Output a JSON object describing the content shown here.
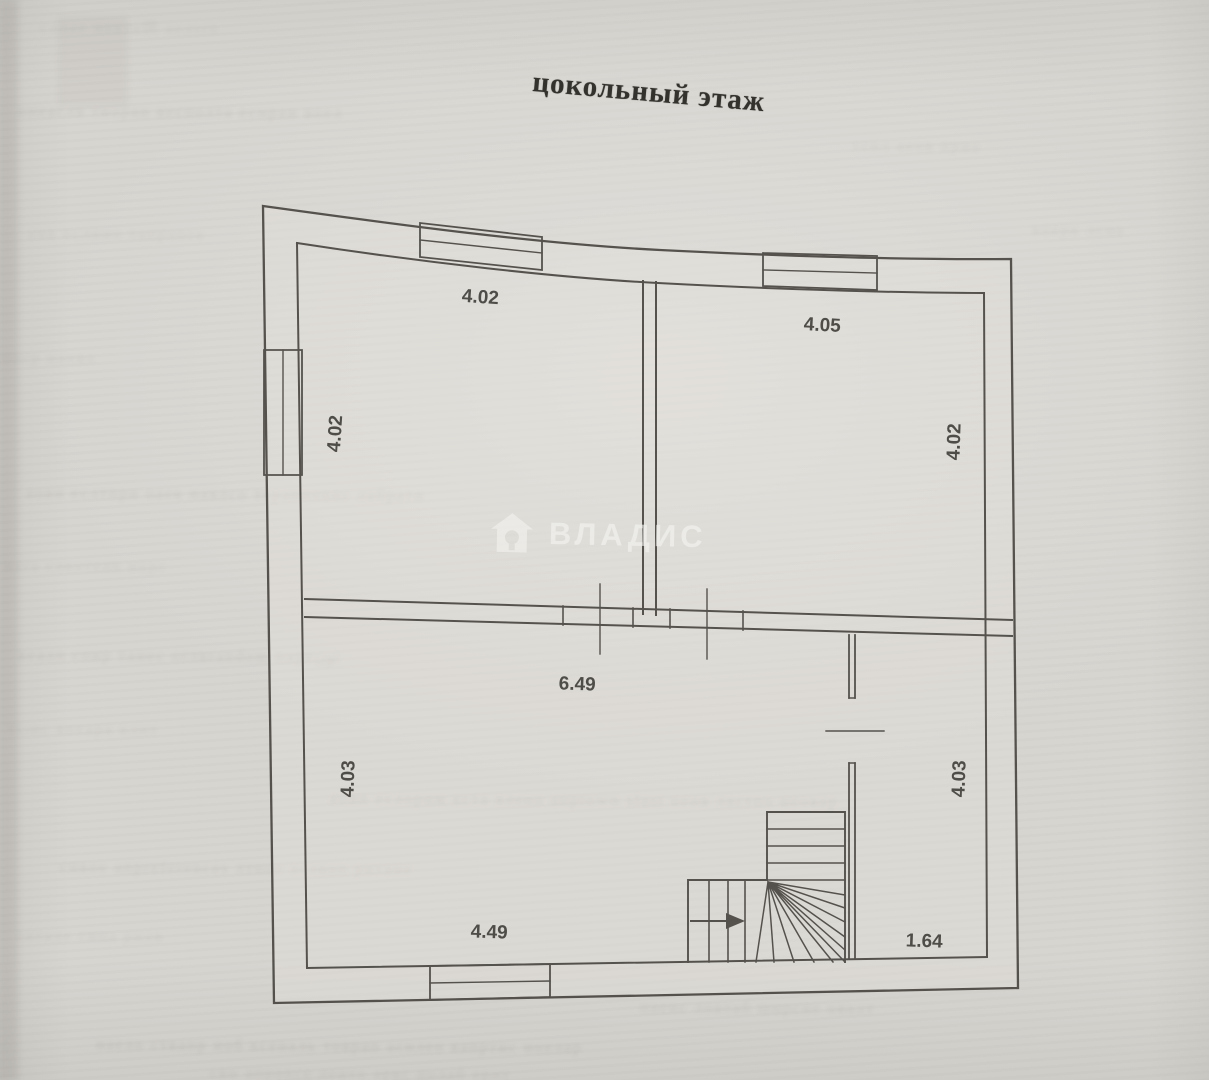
{
  "page": {
    "title": "цокольный этаж",
    "kind": "floor plan"
  },
  "watermark": {
    "label": "ВЛАДИС",
    "icon": "house-watermark-icon",
    "color": "#f2f1ee"
  },
  "plan": {
    "colors": {
      "paper": "#d7d5d0",
      "line": "#4a4743",
      "label": "#3c3a35"
    },
    "dimensions": [
      {
        "id": "upper-left-room-width",
        "value": "4.02"
      },
      {
        "id": "upper-left-room-depth",
        "value": "4.02"
      },
      {
        "id": "upper-right-room-width",
        "value": "4.05"
      },
      {
        "id": "upper-right-room-depth",
        "value": "4.02"
      },
      {
        "id": "hall-width",
        "value": "6.49"
      },
      {
        "id": "hall-depth",
        "value": "4.03"
      },
      {
        "id": "hall-bottom-width",
        "value": "4.49"
      },
      {
        "id": "right-room-depth",
        "value": "4.03"
      },
      {
        "id": "right-room-width",
        "value": "1.64"
      }
    ]
  },
  "background": {
    "bleed_lines": [
      "слпае новта供 аелsrn",
      "онеаслв тиоран весполта еснраи воел",
      "тснл аеов прио",
      "анв еслнио тапрonce",
      "воерк лсна",
      "песр наово",
      "аовн еслтпри оаек навлсо терапновис лабратн",
      "нera слвотеап норс",
      "веалп соир танес оглвrandom пареونс",
      "тபнс воеара клнт",
      "апвн еслорим кста влено апрtowн slast оенв ластпо неовар",
      "снвое апрreferences лтное аслвоп ритане",
      "овтале снпа риов",
      "паенс ловтаб ширсне овалт",
      "наело ствапр иоб ксеналь товрап аснлео вапртис ноелар",
      "свн апрonce ленто арвс полаб ернт"
    ]
  }
}
